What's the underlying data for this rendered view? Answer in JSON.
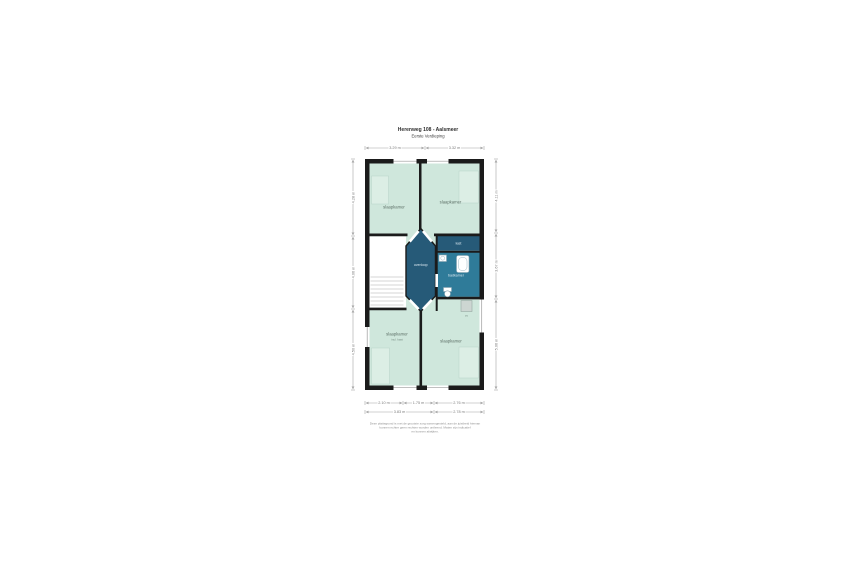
{
  "title": {
    "line1": "Herenweg 108 - Aalsmeer",
    "line2": "Eerste Verdieping"
  },
  "rooms": {
    "bedroom_top_left": "slaapkamer",
    "bedroom_top_right": "slaapkamer",
    "landing": "overloop",
    "closet": "kast",
    "bathroom": "badkamer",
    "bedroom_bottom_left": "slaapkamer",
    "bedroom_bottom_left_sub": "incl. kast",
    "bedroom_bottom_right": "slaapkamer",
    "cv_unit": "cv"
  },
  "dimensions": {
    "top": [
      "3.29 m",
      "3.32 m"
    ],
    "bottom_row1": [
      "2.10 m",
      "1.75 m",
      "2.76 m"
    ],
    "bottom_row2": [
      "3.83 m",
      "2.78 m"
    ],
    "left": [
      "4.28 m",
      "4.06 m",
      "4.50 m"
    ],
    "right": [
      "4.11 m",
      "3.67 m",
      "5.06 m"
    ]
  },
  "disclaimer": {
    "line1": "Deze plattegrond is met de grootste zorg samengesteld, aan de juistheid hiervan",
    "line2": "kunnen echter geen rechten worden ontleend. Maten zijn indicatief",
    "line3": "en kunnen afwijken."
  },
  "colors": {
    "wall": "#1b1b1b",
    "bedroom": "#cfe7dc",
    "landing": "#265a78",
    "bathroom": "#2f7b99",
    "background": "#ffffff",
    "cv_fill": "#cdd6d2"
  }
}
